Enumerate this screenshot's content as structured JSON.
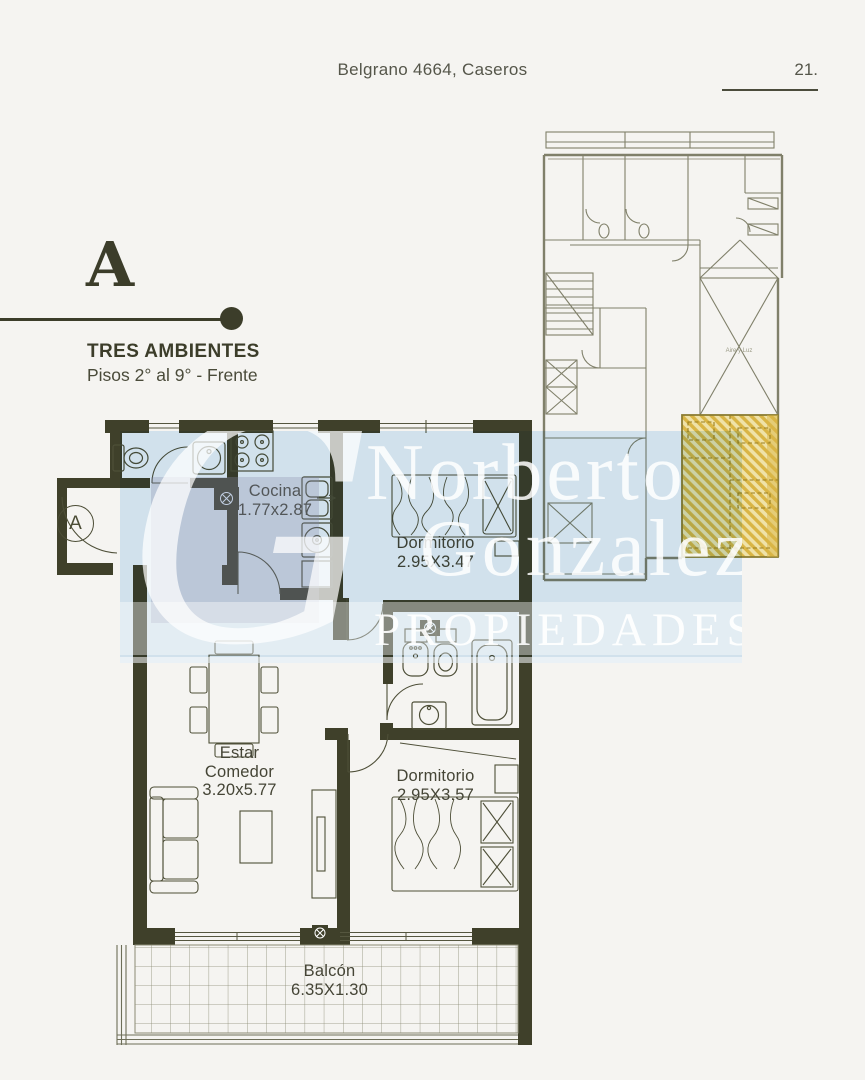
{
  "header": {
    "address": "Belgrano 4664, Caseros",
    "page_number": "21."
  },
  "unit": {
    "letter": "A",
    "name": "TRES AMBIENTES",
    "floors": "Pisos 2° al 9° - Frente"
  },
  "plan": {
    "entrance_label": "A",
    "rooms": {
      "kitchen": {
        "name": "Cocina",
        "dims": "1.77x2.87"
      },
      "bedroom1": {
        "name": "Dormitorio",
        "dims": "2.95X3.47"
      },
      "living": {
        "line1": "Estar",
        "line2": "Comedor",
        "dims": "3.20x5.77"
      },
      "bedroom2": {
        "name": "Dormitorio",
        "dims": "2.95X3.57"
      },
      "balcony": {
        "name": "Balcón",
        "dims": "6.35X1.30"
      }
    }
  },
  "keyplan": {
    "light_well_label": "Aire y Luz"
  },
  "watermark": {
    "line1": "Norberto",
    "line2": "Gonzalez",
    "line3": "PROPIEDADES"
  },
  "colors": {
    "wall": "#3f402a",
    "accent_text": "#3c3d2a",
    "watermark_blue": "#daecfa",
    "highlight_yellow": "#d9b545"
  }
}
